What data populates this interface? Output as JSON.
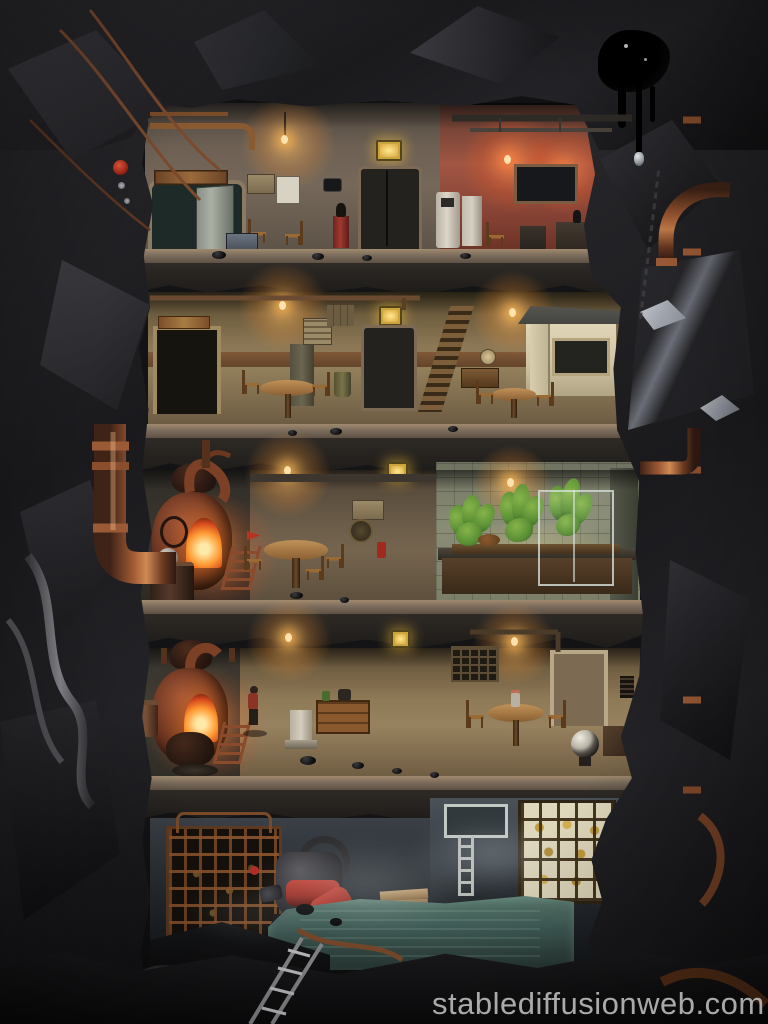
{
  "image": {
    "kind": "ai-generated artwork photo",
    "subject": "cutaway diorama of a five-level underground bunker carved into dark coal rock, joined by rusty copper pipes",
    "watermark_text": "stablediffusionweb.com",
    "levels": [
      {
        "label": "top workshop",
        "objects": "open vault door, hanging lamp, elevator door with lit sign, white dispenser, red-lit kitchen with window, crate, chairs"
      },
      {
        "label": "lounge floor",
        "objects": "elevator, locker, poster, round cafe table with chairs, wooden staircase, white kiosk with dark window, wall clock"
      },
      {
        "label": "boiler and garden floor",
        "objects": "rusty furnace with burning fire, kettle, ladder, dining table, hydroponic planter with green plants, glass grow frame, grow light"
      },
      {
        "label": "quarters floor",
        "objects": "second furnace, worker figure in red jacket, white pedestal, wooden dresser, bottle shelf, dining table with vase, black-and-white globe, door"
      },
      {
        "label": "flooded cellar",
        "objects": "rusted storage cage with bottles, red pump machine, wooden planks, wall ladder, shelf of amber jars, teal water pool, mist, large rusted turbine"
      }
    ]
  },
  "palette": {
    "rockdark": "#141416",
    "rocklite": "#3c3c41",
    "fire": "#ff9a32",
    "firecore": "#ffe9a8",
    "salmon": "#a05643",
    "rust": "#8a4a2c",
    "copper": "#b06a3c",
    "plant": "#5a8f35",
    "plantlite": "#86b44a",
    "water": "#43605a",
    "amber": "#c29a3c",
    "signyellow": "#caa43c",
    "signglow": "#ffe98f",
    "redmachine": "#9e2f26",
    "watermark": "#cdcdcd"
  }
}
